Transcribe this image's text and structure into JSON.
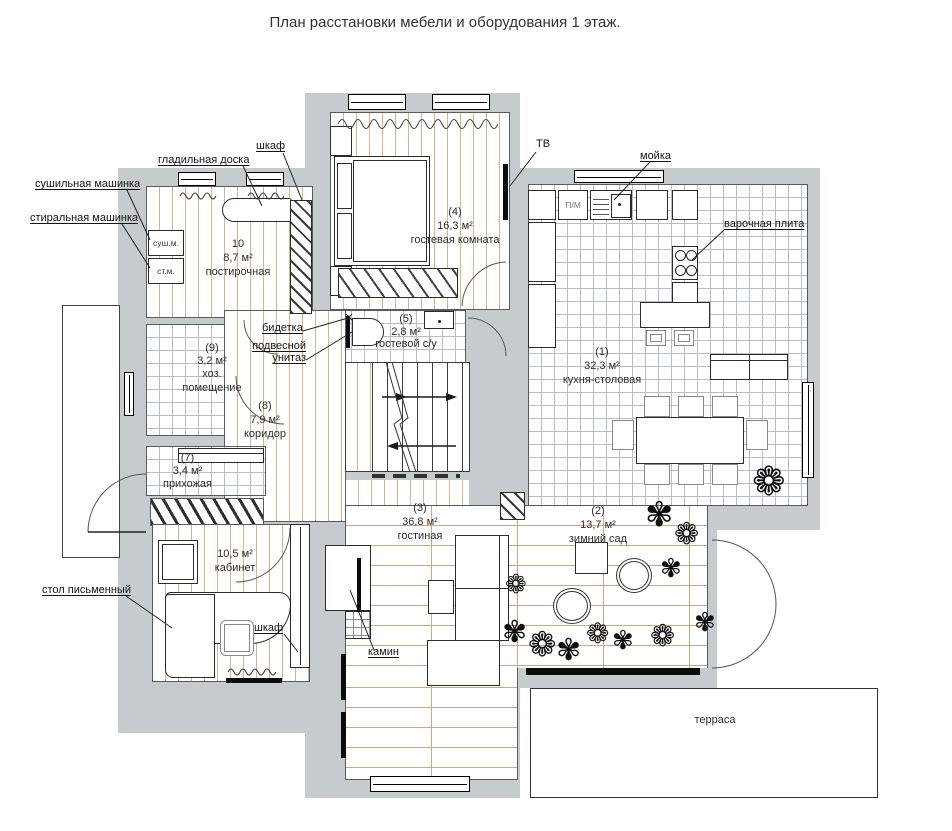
{
  "title": "План расстановки мебели и оборудования 1 этаж.",
  "rooms": {
    "kitchen": {
      "num": "(1)",
      "area": "32,3 м²",
      "name": "кухня-столовая"
    },
    "winter_garden": {
      "num": "(2)",
      "area": "13,7 м²",
      "name": "зимний сад"
    },
    "living": {
      "num": "(3)",
      "area": "36,8 м²",
      "name": "гостиная"
    },
    "guest": {
      "num": "(4)",
      "area": "16,3 м²",
      "name": "гостевая комната"
    },
    "guest_wc": {
      "num": "(5)",
      "area": "2,8 м²",
      "name": "гостевой с/у"
    },
    "office": {
      "num": "",
      "area": "10,5 м²",
      "name": "кабинет"
    },
    "hall": {
      "num": "(7)",
      "area": "3,4 м²",
      "name": "прихожая"
    },
    "corridor": {
      "num": "(8)",
      "area": "7,9 м²",
      "name": "коридор"
    },
    "utility": {
      "num": "(9)",
      "area": "3,2 м²",
      "name": "хоз. помещение"
    },
    "laundry": {
      "num": "10",
      "area": "8,7 м²",
      "name": "постирочная"
    },
    "terrace": {
      "name": "терраса"
    }
  },
  "annotations": {
    "wardrobe_top": "шкаф",
    "ironing_board": "гладильная доска",
    "dryer": "сушильная машинка",
    "washer": "стиральная машинка",
    "tv": "ТВ",
    "sink": "мойка",
    "cooktop": "варочная плита",
    "bidet": "бидетка",
    "wall_toilet": "подвесной унитаз",
    "desk": "стол письменный",
    "wardrobe_office": "шкаф",
    "fireplace": "камин"
  },
  "tags": {
    "dryer": "суш.м.",
    "washer": "ст.м.",
    "dishwasher": "П/М"
  },
  "icons": {
    "plant": "❁",
    "plant2": "✾"
  },
  "colors": {
    "wall": "#c6cbce",
    "wood_line": "#dab28c",
    "tile_line": "#b6bfc6"
  }
}
